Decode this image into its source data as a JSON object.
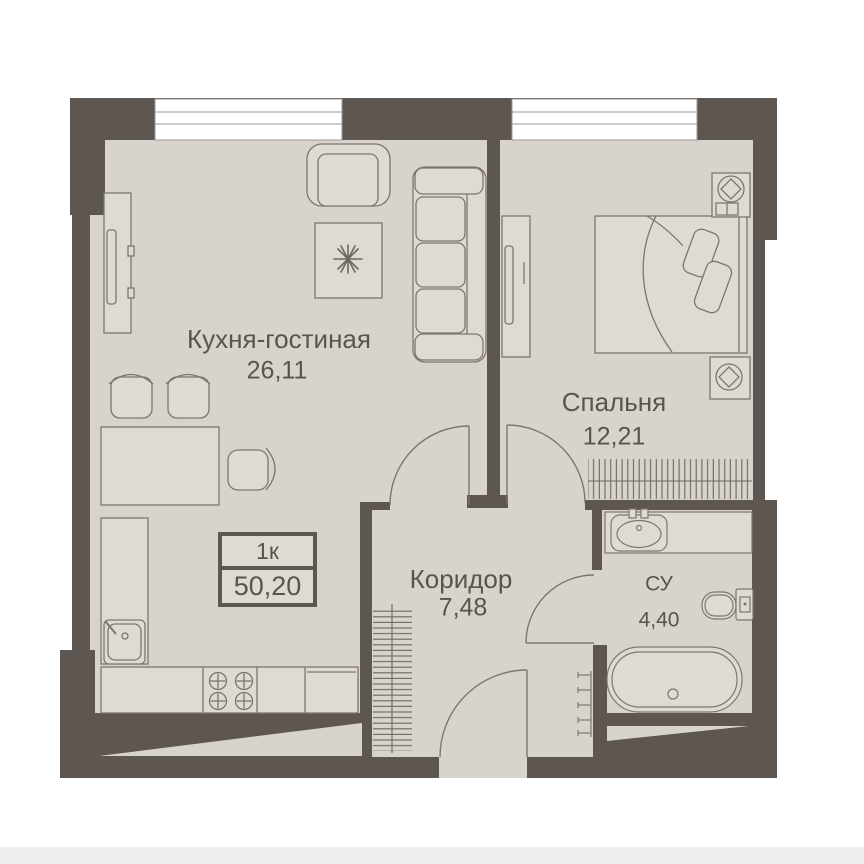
{
  "floor_plan": {
    "badge": {
      "unit_type": "1к",
      "total_area": "50,20"
    },
    "rooms": [
      {
        "name": "Кухня-гостиная",
        "area": "26,11"
      },
      {
        "name": "Спальня",
        "area": "12,21"
      },
      {
        "name": "Коридор",
        "area": "7,48"
      },
      {
        "name": "СУ",
        "area": "4,40"
      }
    ],
    "colors": {
      "wall": "#5e5650",
      "floor": "#d8d4cd",
      "furniture_fill": "#dedbd4",
      "outline": "#7e766e",
      "text": "#5b544e",
      "window_frame": "#9a9a9a",
      "footer_strip": "#f0eeec"
    }
  }
}
